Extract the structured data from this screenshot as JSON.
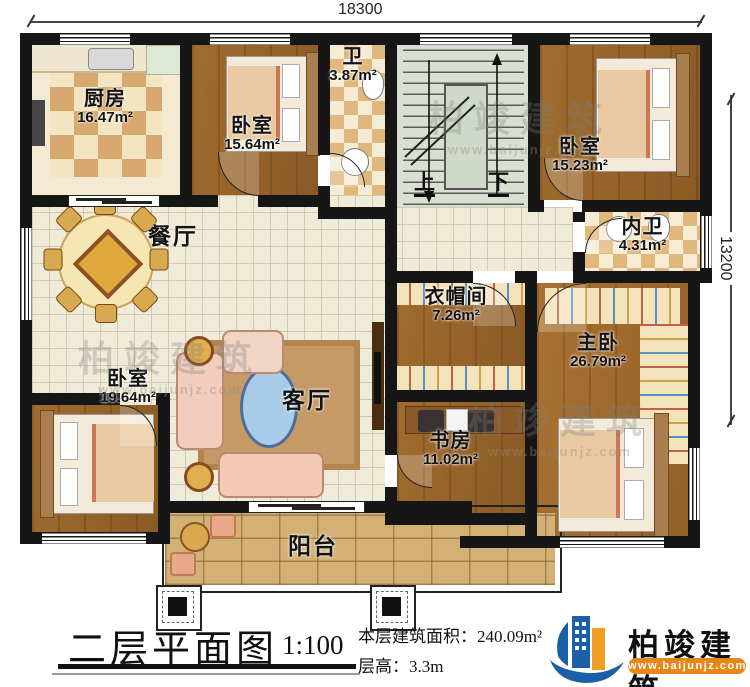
{
  "plan": {
    "dimensions": {
      "width": "18300",
      "height": "13200"
    },
    "stairs": {
      "up": "上",
      "down": "下"
    },
    "rooms": [
      {
        "id": "kitchen",
        "name": "厨房",
        "area": "16.47m²"
      },
      {
        "id": "bedroom-top",
        "name": "卧室",
        "area": "15.64m²"
      },
      {
        "id": "bath",
        "name": "卫",
        "area": "3.87m²"
      },
      {
        "id": "bedroom-top-right",
        "name": "卧室",
        "area": "15.23m²"
      },
      {
        "id": "inner-bath",
        "name": "内卫",
        "area": "4.31m²"
      },
      {
        "id": "dining",
        "name": "餐厅",
        "area": ""
      },
      {
        "id": "cloakroom",
        "name": "衣帽间",
        "area": "7.26m²"
      },
      {
        "id": "master-bedroom",
        "name": "主卧",
        "area": "26.79m²"
      },
      {
        "id": "bedroom-bottom-left",
        "name": "卧室",
        "area": "19.64m²"
      },
      {
        "id": "living",
        "name": "客厅",
        "area": ""
      },
      {
        "id": "study",
        "name": "书房",
        "area": "11.02m²"
      },
      {
        "id": "balcony",
        "name": "阳台",
        "area": ""
      }
    ]
  },
  "footer": {
    "title": "二层平面图",
    "scale": "1:100",
    "area_line": "本层建筑面积：240.09m²",
    "floor_height_line": "层高：3.3m"
  },
  "brand": {
    "name": "柏竣建筑",
    "website": "www.baijunjz.com"
  },
  "watermark": {
    "name": "柏竣建筑",
    "website": "www.baijunjz.com"
  },
  "palette": {
    "wall": "#161616",
    "wood": "#96632a",
    "tile": "#f0ebd8",
    "checker_dark": "#d7a86f",
    "stone": "#d3b176",
    "brand_blue": "#1b5fa8",
    "brand_orange": "#e8861a"
  }
}
